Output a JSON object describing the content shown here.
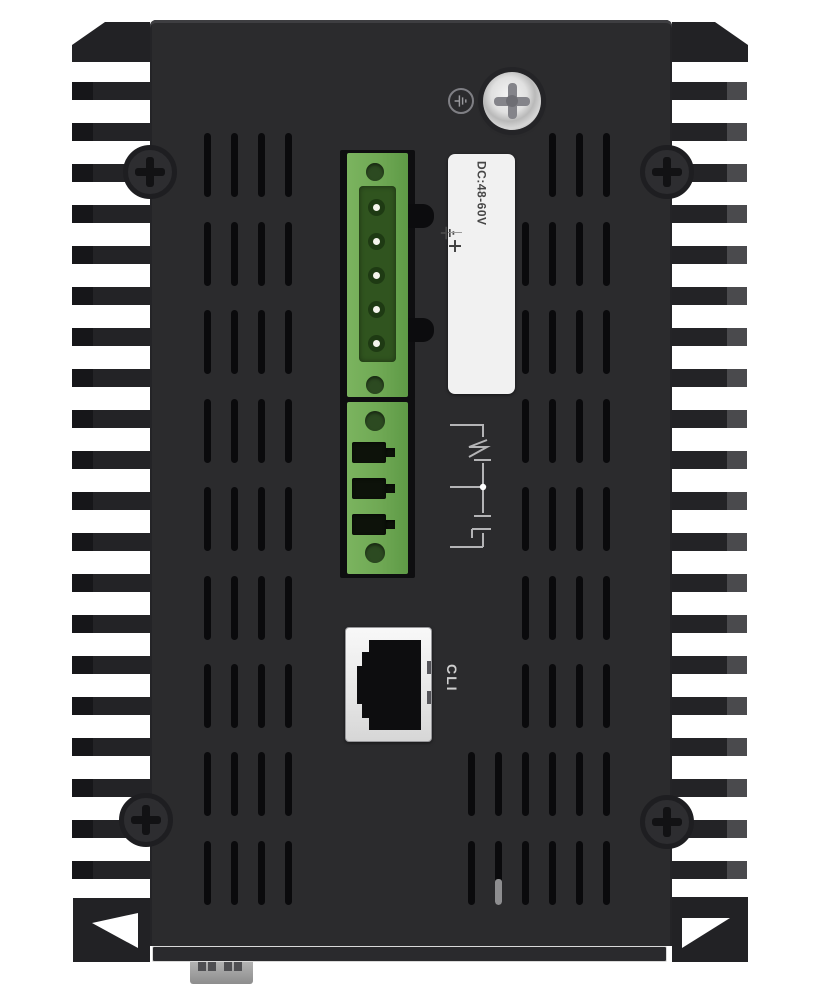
{
  "background_color": "#ffffff",
  "chassis_color": "#2b2b2d",
  "power_input": {
    "label_title": "DC:48-60V",
    "terminals": [
      "+",
      "−",
      "GND",
      "−",
      "+"
    ],
    "pin_count": 5,
    "connector_color": "#6FA854"
  },
  "relay_output": {
    "slot_count": 3,
    "connector_color": "#6FA854"
  },
  "console_port": {
    "label": "CLI",
    "type": "RJ45"
  },
  "icons": {
    "ground_circle": "protective-earth-icon",
    "panel_screw": "phillips-screw-icon",
    "corner_screw": "phillips-screw-icon",
    "relay_diagram": "spdt-relay-contact-icon"
  }
}
